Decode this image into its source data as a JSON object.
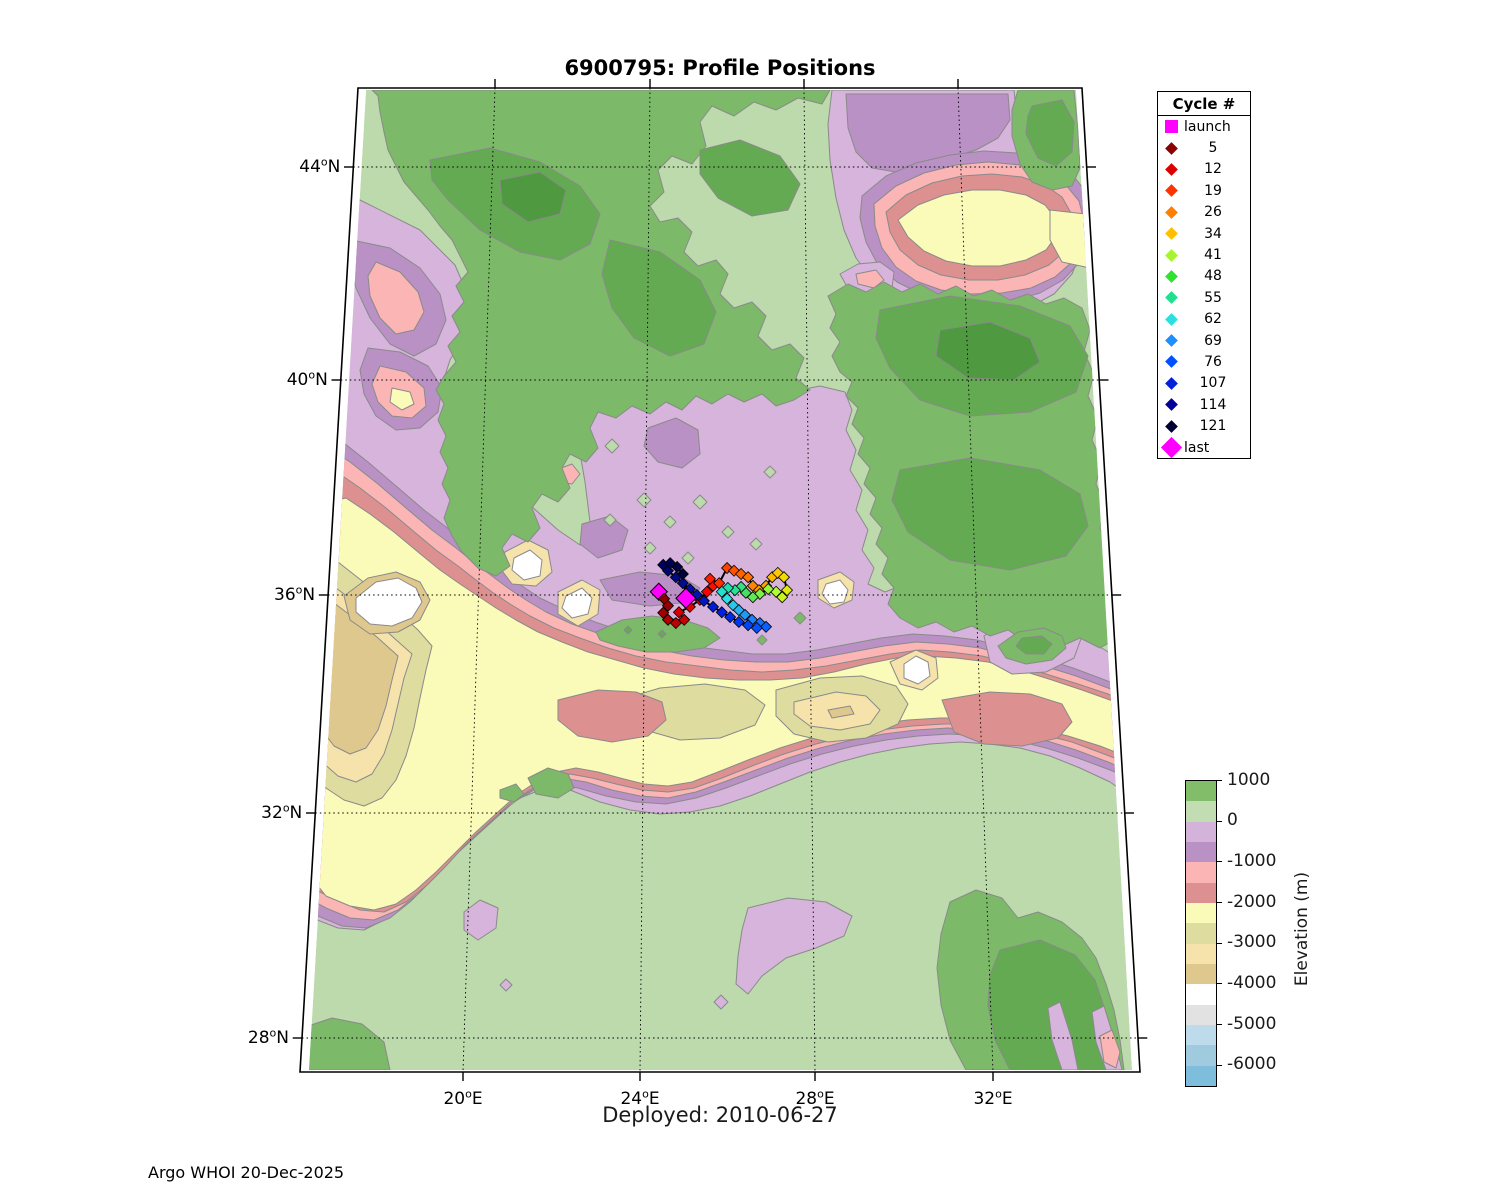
{
  "figure": {
    "title": "6900795: Profile Positions",
    "xlabel": "Deployed: 2010-06-27",
    "footer": "Argo WHOI 20-Dec-2025"
  },
  "legend": {
    "title": "Cycle #",
    "items": [
      {
        "label": "launch",
        "color": "#ff00ff",
        "marker": "square"
      },
      {
        "label": "5",
        "color": "#8b0000",
        "marker": "diamond"
      },
      {
        "label": "12",
        "color": "#dd0000",
        "marker": "diamond"
      },
      {
        "label": "19",
        "color": "#ff3300",
        "marker": "diamond"
      },
      {
        "label": "26",
        "color": "#ff8000",
        "marker": "diamond"
      },
      {
        "label": "34",
        "color": "#ffbf00",
        "marker": "diamond"
      },
      {
        "label": "41",
        "color": "#a6f42c",
        "marker": "diamond"
      },
      {
        "label": "48",
        "color": "#2ee32e",
        "marker": "diamond"
      },
      {
        "label": "55",
        "color": "#1fe08c",
        "marker": "diamond"
      },
      {
        "label": "62",
        "color": "#2bdfdf",
        "marker": "diamond"
      },
      {
        "label": "69",
        "color": "#1e8fff",
        "marker": "diamond"
      },
      {
        "label": "76",
        "color": "#0050ff",
        "marker": "diamond"
      },
      {
        "label": "107",
        "color": "#0020dd",
        "marker": "diamond"
      },
      {
        "label": "114",
        "color": "#000099",
        "marker": "diamond"
      },
      {
        "label": "121",
        "color": "#000033",
        "marker": "diamond"
      },
      {
        "label": "last",
        "color": "#ff00ff",
        "marker": "diamond-large"
      }
    ]
  },
  "colorbar": {
    "label": "Elevation (m)",
    "ticks": [
      "1000",
      "0",
      "-1000",
      "-2000",
      "-3000",
      "-4000",
      "-5000",
      "-6000"
    ],
    "segment_colors": [
      "#82bd69",
      "#c2ddb2",
      "#d3b3da",
      "#b991c4",
      "#fbb5b5",
      "#dd9090",
      "#fafab9",
      "#dedc9e",
      "#f6e3ac",
      "#dfc88e",
      "#ffffff",
      "#e2e2e2",
      "#bedbeb",
      "#a0cade",
      "#7fbddd"
    ]
  },
  "map": {
    "lat_ticks": [
      {
        "deg": "44",
        "hemi": "N",
        "value": 44
      },
      {
        "deg": "40",
        "hemi": "N",
        "value": 40
      },
      {
        "deg": "36",
        "hemi": "N",
        "value": 36
      },
      {
        "deg": "32",
        "hemi": "N",
        "value": 32
      },
      {
        "deg": "28",
        "hemi": "N",
        "value": 28
      }
    ],
    "lon_ticks": [
      {
        "deg": "20",
        "hemi": "E",
        "value": 20
      },
      {
        "deg": "24",
        "hemi": "E",
        "value": 24
      },
      {
        "deg": "28",
        "hemi": "E",
        "value": 28
      },
      {
        "deg": "32",
        "hemi": "E",
        "value": 32
      }
    ]
  },
  "chart_data": {
    "type": "scatter",
    "title": "6900795: Profile Positions",
    "xlabel": "Deployed: 2010-06-27",
    "x_axis": {
      "label": "Longitude (deg E)",
      "ticks": [
        20,
        24,
        28,
        32
      ],
      "range": [
        16.2,
        35.4
      ]
    },
    "y_axis": {
      "label": "Latitude (deg N)",
      "ticks": [
        28,
        32,
        36,
        40,
        44
      ],
      "range": [
        27.6,
        45.3
      ]
    },
    "projection": "conic",
    "legend_cycles": [
      5,
      12,
      19,
      26,
      34,
      41,
      48,
      55,
      62,
      69,
      76,
      107,
      114,
      121
    ],
    "elevation_scale_m": {
      "max": 1000,
      "min": -6500,
      "step": 500
    },
    "launch": {
      "lon": 24.43,
      "lat": 36.06,
      "color": "#ff00ff"
    },
    "last": {
      "lon": 25.05,
      "lat": 35.94,
      "color": "#ff00ff"
    },
    "trajectory": {
      "lon": [
        24.55,
        24.64,
        24.53,
        24.64,
        24.82,
        25.01,
        24.89,
        25.14,
        25.37,
        25.53,
        25.67,
        25.6,
        25.81,
        25.99,
        26.15,
        26.31,
        26.47,
        26.58,
        26.72,
        26.88,
        27.02,
        27.15,
        27.29,
        27.36,
        27.25,
        27.11,
        26.93,
        26.74,
        26.58,
        26.42,
        26.31,
        26.17,
        26.01,
        25.87,
        25.99,
        26.13,
        26.26,
        26.4,
        26.56,
        26.74,
        26.88,
        26.67,
        26.47,
        26.26,
        26.06,
        25.87,
        25.67,
        25.46,
        25.3,
        25.14,
        24.98,
        24.82,
        24.64,
        24.53,
        24.69,
        24.85,
        24.98,
        25.05
      ],
      "lat": [
        35.93,
        35.8,
        35.67,
        35.54,
        35.48,
        35.54,
        35.68,
        35.78,
        35.91,
        36.06,
        36.17,
        36.3,
        36.22,
        36.5,
        36.45,
        36.39,
        36.33,
        36.17,
        36.09,
        36.17,
        36.33,
        36.41,
        36.33,
        36.09,
        35.96,
        36.06,
        36.11,
        36.02,
        35.96,
        36.04,
        36.15,
        36.09,
        36.13,
        36.06,
        35.93,
        35.81,
        35.72,
        35.63,
        35.54,
        35.48,
        35.41,
        35.39,
        35.44,
        35.5,
        35.59,
        35.68,
        35.78,
        35.89,
        36.0,
        36.11,
        36.22,
        36.33,
        36.45,
        36.56,
        36.59,
        36.52,
        36.39,
        35.98
      ],
      "colors": [
        "#8b0000",
        "#970000",
        "#a40000",
        "#b00000",
        "#bd0000",
        "#c90000",
        "#d60000",
        "#e20000",
        "#ef0000",
        "#fb0000",
        "#ff0e00",
        "#ff1f00",
        "#ff3000",
        "#ff4100",
        "#ff5200",
        "#ff6300",
        "#ff7400",
        "#ff8500",
        "#ff9600",
        "#ffa700",
        "#ffb800",
        "#ffc900",
        "#f4da00",
        "#e0ea10",
        "#c8f520",
        "#aeff2f",
        "#94f83c",
        "#7af048",
        "#60e855",
        "#46e061",
        "#38e07c",
        "#2ae096",
        "#1ce0b1",
        "#24dfcc",
        "#2cdfe6",
        "#28c8ec",
        "#24b0f2",
        "#2098f8",
        "#1c80fe",
        "#1470ff",
        "#0c60ff",
        "#0450ff",
        "#0044f8",
        "#0038f0",
        "#002ce8",
        "#0020e0",
        "#001cd0",
        "#0018c0",
        "#0014b0",
        "#0010a0",
        "#000c90",
        "#000880",
        "#000470",
        "#000060",
        "#000050",
        "#000040",
        "#000038",
        "#000030"
      ]
    }
  }
}
